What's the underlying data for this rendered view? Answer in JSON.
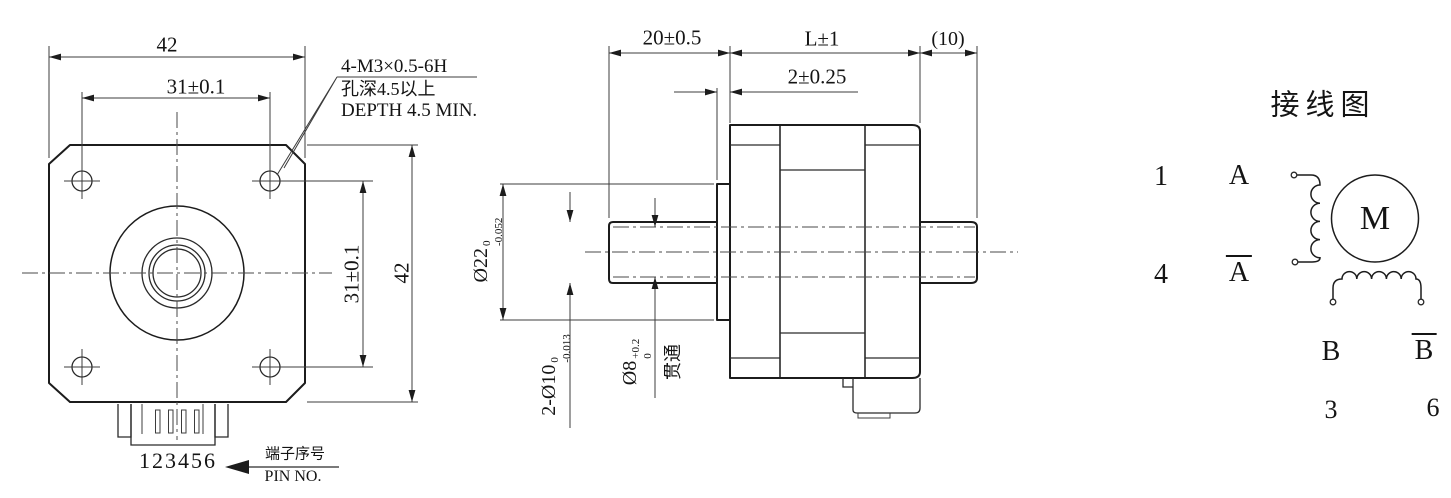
{
  "drawing": {
    "front_view": {
      "width_dim": "42",
      "hole_spacing_horizontal": "31±0.1",
      "hole_spacing_vertical": "31±0.1",
      "height_dim": "42",
      "tapped_hole_callout_line1": "4-M3×0.5-6H",
      "tapped_hole_callout_line2": "孔深4.5以上",
      "tapped_hole_callout_line3": "DEPTH 4.5 MIN.",
      "pin_numbers": "123456",
      "pin_label_cn": "端子序号",
      "pin_label_en": "PIN NO."
    },
    "side_view": {
      "front_shaft_length": "20±0.5",
      "body_length": "L±1",
      "rear_shaft_length": "(10)",
      "boss_thickness": "2±0.25",
      "pilot_diameter": "Ø22",
      "pilot_tol_upper": "0",
      "pilot_tol_lower": "-0.052",
      "shaft_diameter": "2-Ø10",
      "shaft_tol_upper": "0",
      "shaft_tol_lower": "-0.013",
      "bore_diameter": "Ø8",
      "bore_tol_upper": "+0.2",
      "bore_tol_lower": "0",
      "bore_note": "贯通"
    },
    "wiring_diagram": {
      "title": "接线图",
      "pin_1": "1",
      "phase_a": "A",
      "pin_4": "4",
      "phase_a_bar": "A",
      "motor_symbol": "M",
      "phase_b": "B",
      "phase_b_bar": "B",
      "pin_3": "3",
      "pin_6": "6"
    },
    "colors": {
      "line": "#1c1c1c",
      "background": "#ffffff"
    }
  }
}
